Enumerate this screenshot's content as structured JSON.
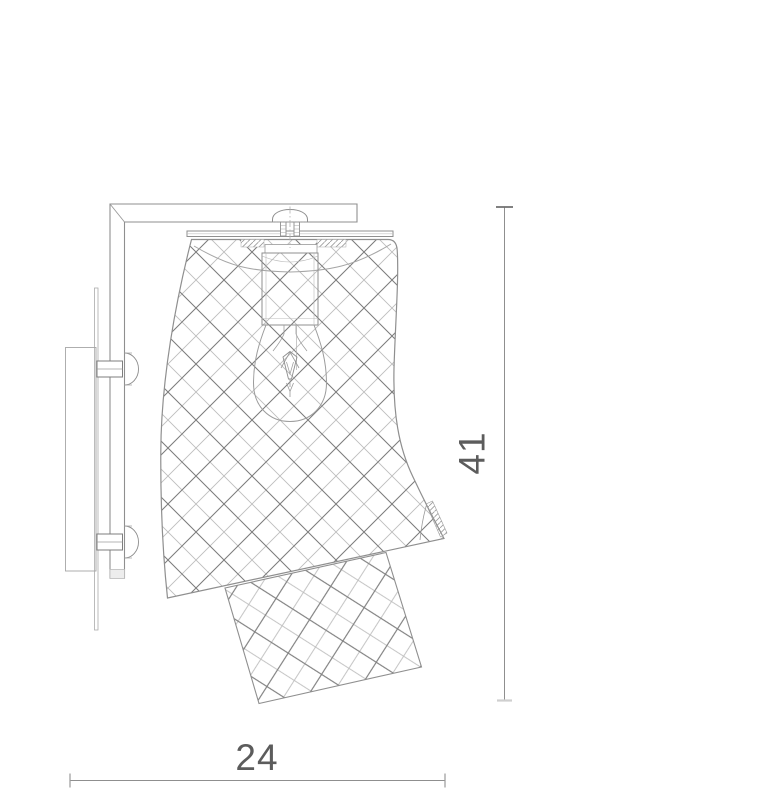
{
  "drawing": {
    "height_value": "41",
    "width_value": "24"
  },
  "colors": {
    "background": "#ffffff",
    "outline": "#8f8f8f",
    "outline_light": "#b0b0b0",
    "hatch_light": "#bdbdbd",
    "hatch_dark": "#7e7e7e",
    "dense_hatch": "#9a9a9a",
    "dimension_line": "#8a8a8a",
    "dimension_text": "#5c5c5c"
  }
}
